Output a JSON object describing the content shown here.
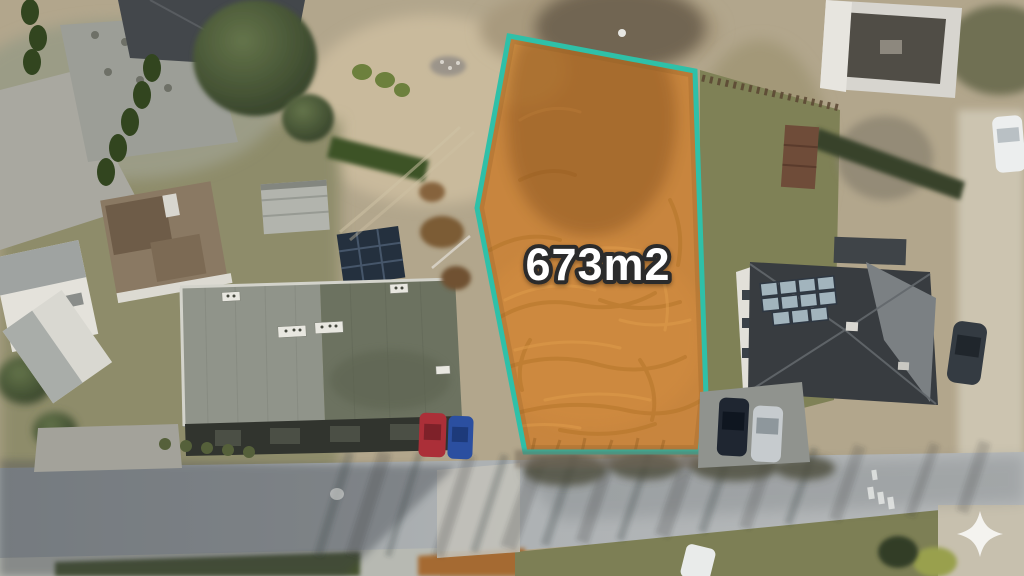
{
  "photo": {
    "kind": "aerial-drone-photo",
    "description": "Top-down drone photo of a residential street; a vacant sandy plot between buildings is highlighted for sale"
  },
  "plot_annotation": {
    "area_label": "673m2",
    "outline_color": "#2fc0a8",
    "overlay_color": "#d97c1f",
    "label_fill_color": "#ffffff",
    "label_outline_color": "#2b2b2b"
  },
  "watermark": {
    "icon": "sparkle-icon",
    "color": "#ffffff"
  }
}
